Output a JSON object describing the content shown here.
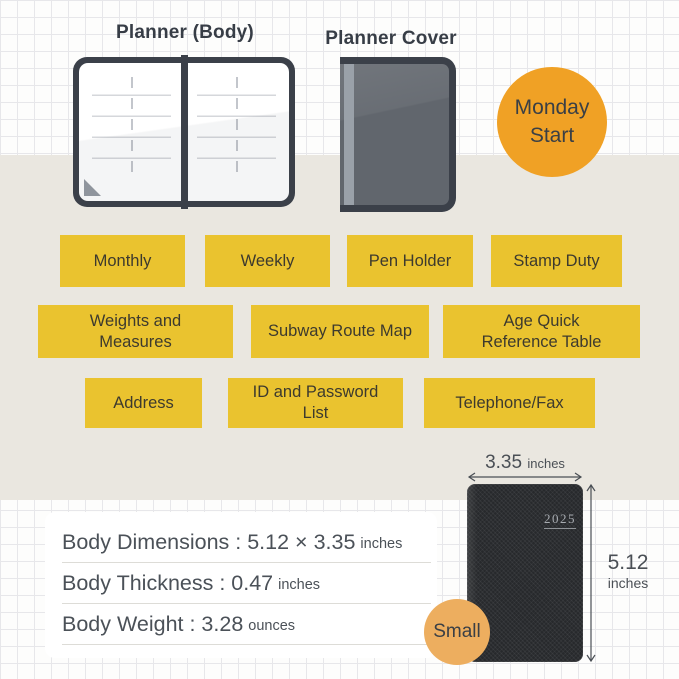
{
  "header": {
    "body_label": "Planner (Body)",
    "cover_label": "Planner Cover"
  },
  "badges": {
    "monday_start": {
      "line1": "Monday",
      "line2": "Start"
    },
    "size": {
      "label": "Small"
    }
  },
  "features": {
    "labels": [
      "Monthly",
      "Weekly",
      "Pen Holder",
      "Stamp Duty",
      "Weights and Measures",
      "Subway Route Map",
      "Age Quick Reference Table",
      "Address",
      "ID and Password List",
      "Telephone/Fax"
    ]
  },
  "specs": {
    "rows": [
      {
        "text": "Body Dimensions : 5.12 × 3.35",
        "unit": "inches"
      },
      {
        "text": "Body Thickness : 0.47",
        "unit": "inches"
      },
      {
        "text": "Body Weight : 3.28",
        "unit": "ounces"
      }
    ]
  },
  "dimensions": {
    "width": "3.35",
    "width_unit": "inches",
    "height": "5.12",
    "height_unit": "inches"
  },
  "photo": {
    "year": "2025"
  },
  "colors": {
    "accent_yellow": "#EAC32F",
    "accent_orange": "#F0A125",
    "accent_orange_light": "#EDAE5F",
    "band_beige": "#EAE7E0",
    "ink": "#3C4149",
    "photo_black": "#27292C"
  }
}
